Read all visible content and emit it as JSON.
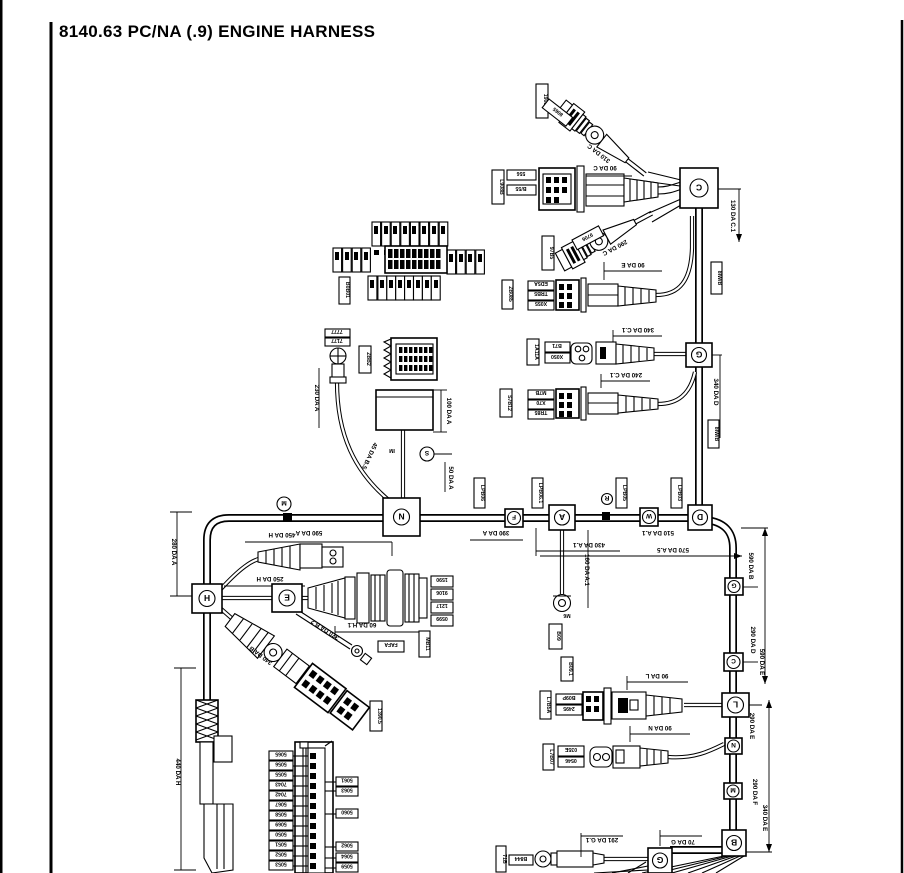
{
  "page": {
    "title": "8140.63 PC/NA (.9) ENGINE HARNESS"
  },
  "junctions": {
    "c": "C",
    "g_top": "G",
    "d": "D",
    "n": "N",
    "f": "F",
    "a": "A",
    "w": "W",
    "h": "H",
    "e": "E",
    "g1": "G",
    "c2": "C",
    "l": "L",
    "n2": "N",
    "m2": "M",
    "b": "B",
    "g3": "G",
    "m_mini": "M",
    "r_mini": "R",
    "s_mini": "S"
  },
  "dims": {
    "d280a": "280 DA A",
    "d440h": "440 DA H",
    "d450h": "450 DA H",
    "d250h": "250 DA H",
    "d60h1": "60 DA H.1",
    "d340b": "340 DA B",
    "d370b2": "370 DA B.2",
    "d590a": "590 DA A",
    "d390a": "390 DA A",
    "d430a1": "430 DA A.1",
    "d510a1": "510 DA A.1",
    "d570a5": "570 DA A.5",
    "d160a1": "160 DA A.1",
    "d230a": "230 DA A",
    "d100a": "100 DA A",
    "d45b5": "45 DA B.5",
    "d50a": "50 DA A",
    "d130c1": "130 DA C.1",
    "d340d": "340 DA D",
    "d310c": "310 DA C",
    "d290c": "290 DA C",
    "d90c": "90 DA C",
    "d90e": "90 DA E",
    "d340c1": "340 DA C.1",
    "d240c1": "240 DA C.1",
    "d90l": "90 DA L",
    "d90n": "90 DA N",
    "d291g1": "291 DA G.1",
    "d70g": "70 DA G",
    "d590b": "590 DA B",
    "d290d": "290 DA D",
    "d590e": "590 DA E",
    "d290e": "290 DA E",
    "d290f": "290 DA F",
    "d340e": "340 DA E",
    "m6": "M6",
    "im": "IM"
  },
  "codes": {
    "c19080": "19080",
    "c8065": "8065",
    "cl908b": "L908B",
    "c556": "556",
    "cb55": "B/55",
    "c97b5": "97B5",
    "c9706": "9706",
    "czb085": "ZB085",
    "ced5a": "ED5A",
    "ctrb5": "TRB5",
    "cx055": "X055",
    "c1a11a": "1A11A",
    "cb71": "B71",
    "cx050": "X050",
    "cs7b12": "S7B12",
    "cm7b": "M7B",
    "cx70": "X70",
    "ctr85": "TR85",
    "c7777": "7777",
    "c7177": "7177",
    "czbb2": "ZBB2",
    "cb0b01": "B0B01",
    "cb0b05": "B0B05",
    "c1590": "1590",
    "c9106": "9106",
    "c1217": "1217",
    "c0599": "0599",
    "cfafa": "FAFA",
    "cmb11": "MB11",
    "c13905": "1390.5",
    "cl7b5a": "L7B5A",
    "cb09p": "B09P",
    "c2495": "2495",
    "c035e": "035E",
    "c0546": "0546",
    "cl7b07": "L7B07",
    "cb844": "B844",
    "c71b": "71B",
    "cb09": "B09",
    "cb091": "B09.1",
    "clp1": "LPB06",
    "clp2": "LPB06.1",
    "clp3": "LPB05",
    "clp4": "LPB03",
    "c8iwb": "8IW/B",
    "c8iwb2": "8IW/B"
  },
  "fusebox": {
    "left": [
      "5065",
      "5056",
      "5055",
      "7043",
      "7042",
      "5067",
      "5058",
      "5069",
      "5050",
      "5051",
      "5052",
      "5053"
    ],
    "right": [
      "5061",
      "5063",
      "5060",
      "5062",
      "5064",
      "5059"
    ]
  }
}
